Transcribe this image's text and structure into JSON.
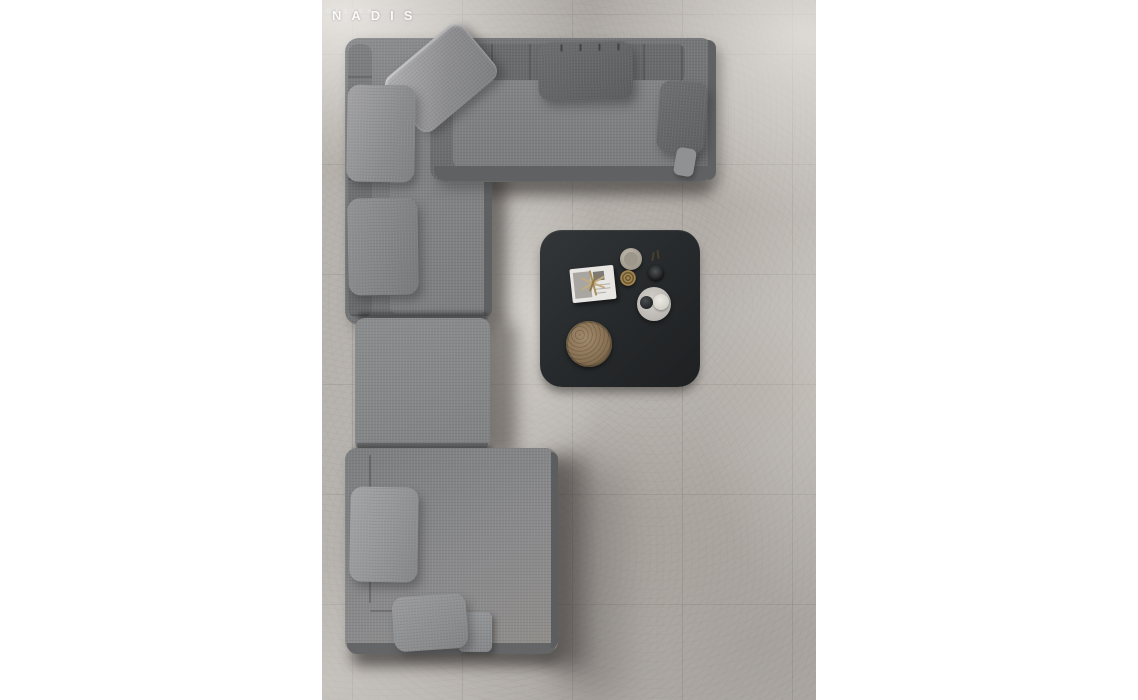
{
  "meta": {
    "type": "product-photo",
    "subject": "Top-down view of a modular gray fabric corner sofa with throw pillows and a black square coffee table with decor objects, on large-format concrete tile floor"
  },
  "brand": {
    "name": "NADIS",
    "subtitle": "DESIGN"
  },
  "palette": {
    "page_background": "#ffffff",
    "floor_base": "#b7b3ae",
    "floor_highlight": "#dcd8d3",
    "floor_shadow": "#8f8b86",
    "sofa_fabric": "#7e8082",
    "sofa_fabric_dark": "#616365",
    "sofa_fabric_light": "#9b9b9d",
    "table": "#26292b",
    "tray_bronze": "#8a7355",
    "bowl_brass": "#8a744f",
    "plate": "#c6c2bc",
    "magazine": "#e8e6e2",
    "logo_text": "#ffffff"
  },
  "objects": {
    "sofa": {
      "label": "modular corner sofa",
      "sections": [
        "top chaise section",
        "left seat section",
        "center ottoman",
        "bottom lounge section",
        "small armrest block"
      ],
      "pillow_count": 7
    },
    "table": {
      "label": "black square coffee table",
      "items": [
        "magazine with wire sculpture",
        "ceramic cup",
        "brass ribbed bowl",
        "black cup",
        "serving plate with dark bowl and cream bowl",
        "bronze textured tray",
        "dry sprigs"
      ]
    }
  }
}
